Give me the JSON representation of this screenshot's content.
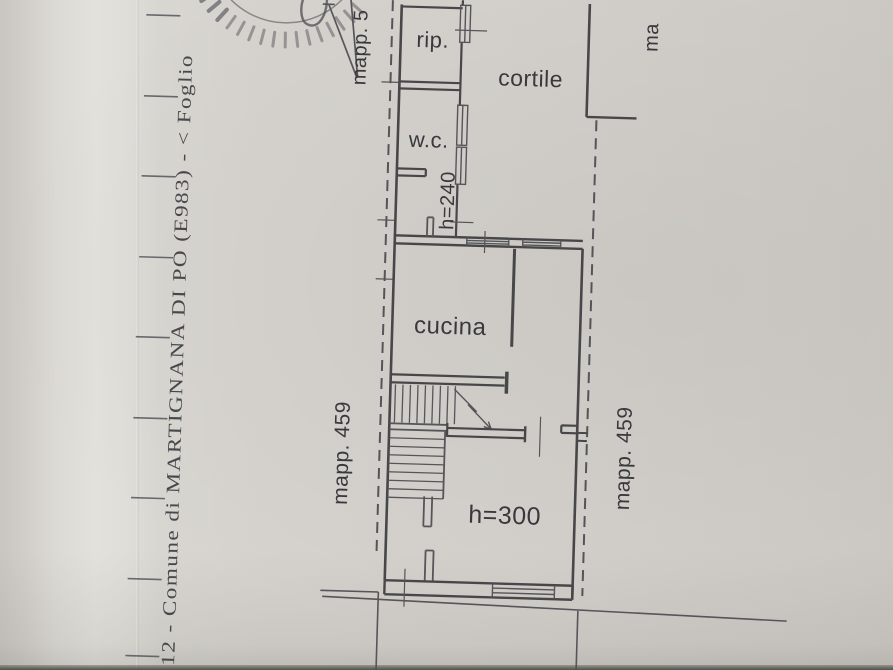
{
  "photo": {
    "paper_color": "#d6d3ce",
    "ink_color": "#47474a",
    "bottom_edge_color": "#4e5249"
  },
  "margin": {
    "caption": "12 - Comune di MARTIGNANA DI PO (E983) - < Foglio"
  },
  "plan": {
    "parcels": {
      "top_pointer": "mapp. 5",
      "top_right_clipped": "ma",
      "left": "mapp. 459",
      "right": "mapp. 459"
    },
    "rooms": {
      "storage": "rip.",
      "courtyard": "cortile",
      "wc": "w.c.",
      "kitchen": "cucina"
    },
    "heights": {
      "wc_level": "h=240",
      "main_level": "h=300"
    }
  }
}
